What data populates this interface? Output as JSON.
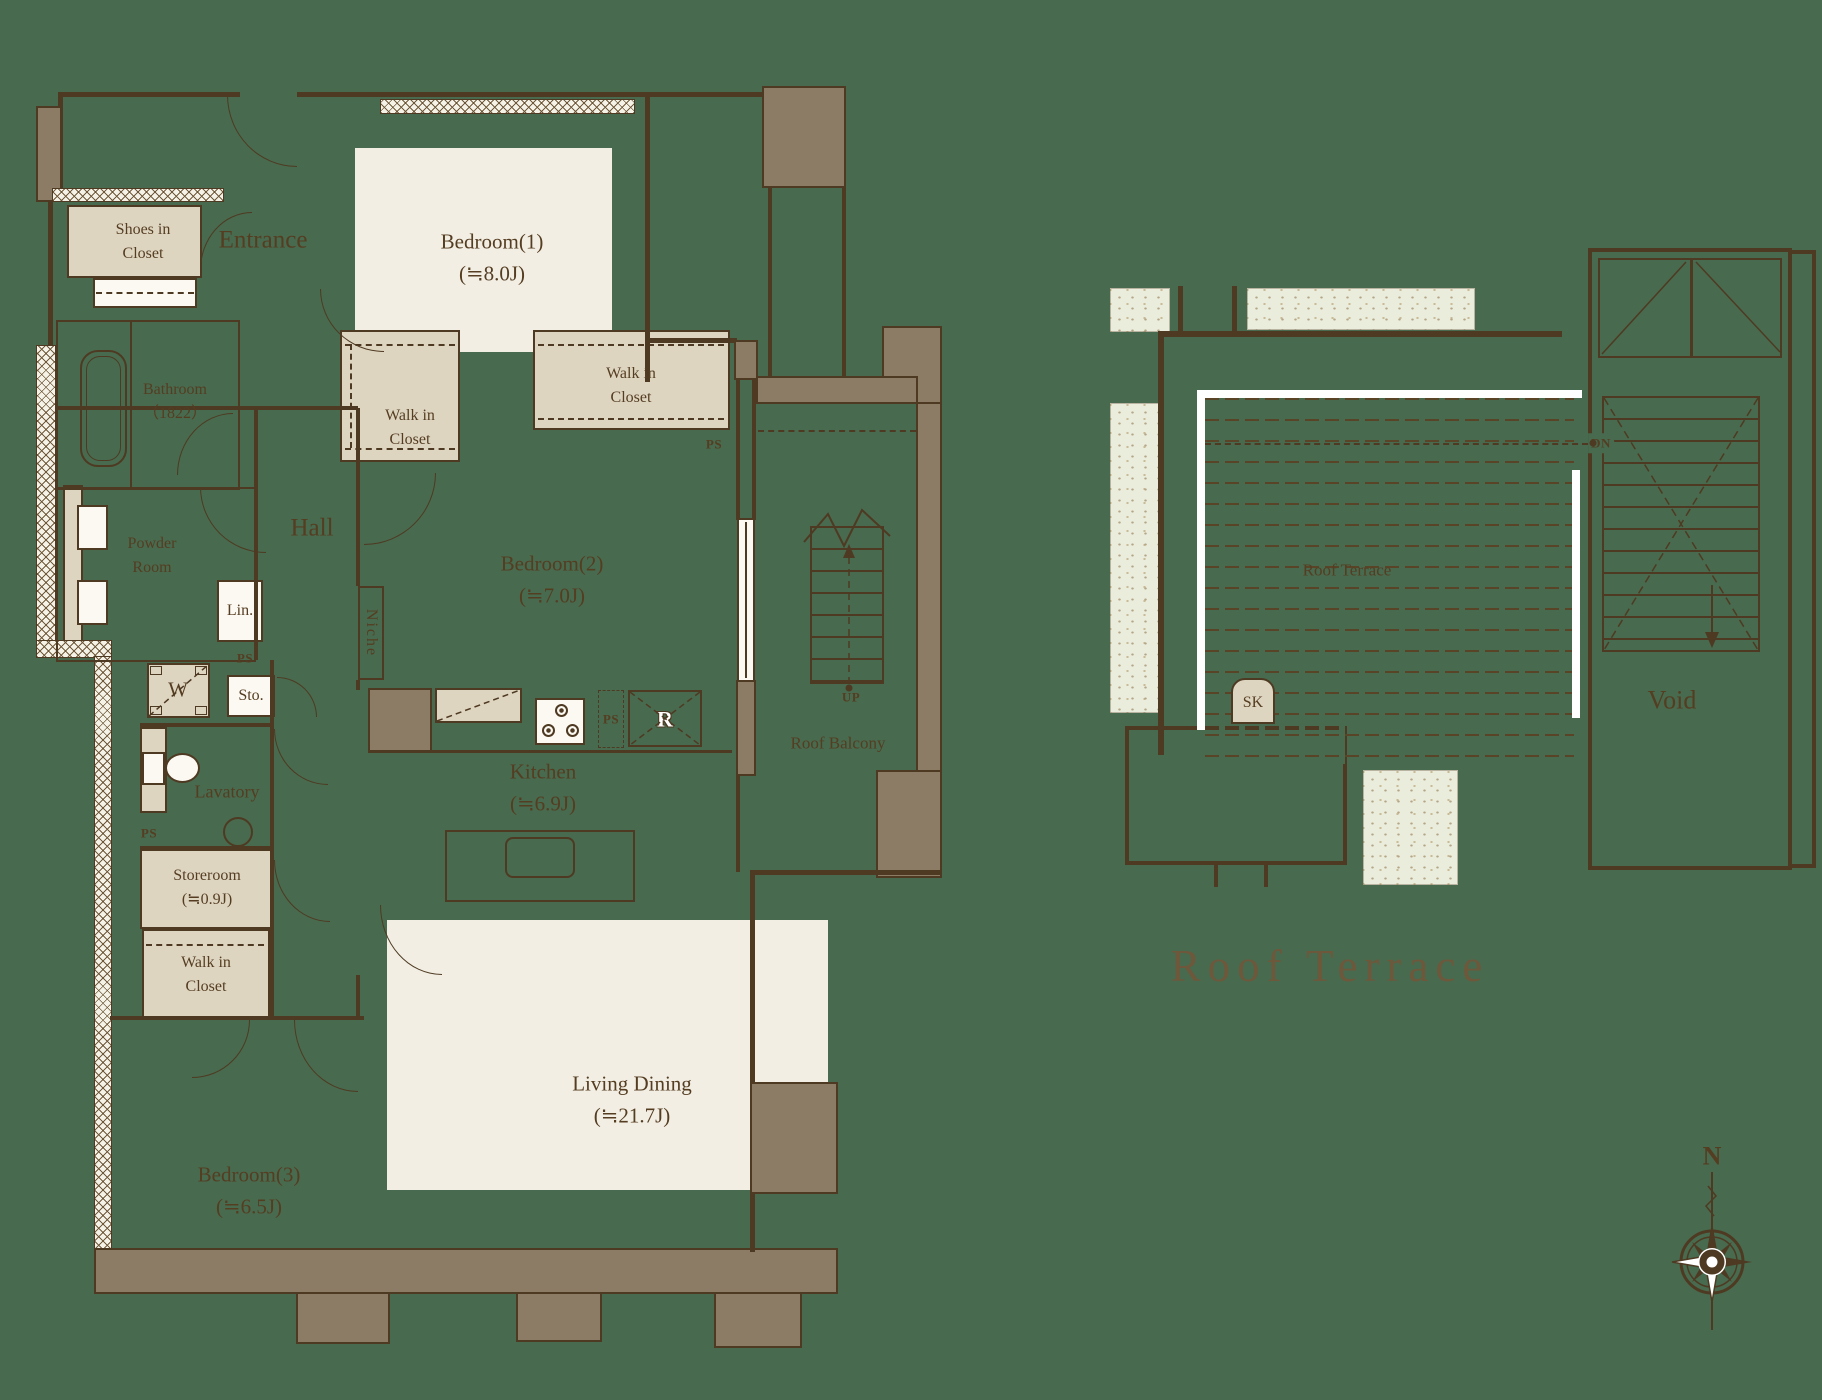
{
  "plan": {
    "unit": {
      "entrance": "Entrance",
      "shoes_closet": "Shoes in\nCloset",
      "bedroom1": "Bedroom(1)\n(≒8.0J)",
      "wic_left": "Walk in\nCloset",
      "wic_right": "Walk in\nCloset",
      "wic_bottom": "Walk in\nCloset",
      "ps_wic": "PS",
      "bathroom": "Bathroom\n（1822）",
      "powder_room": "Powder\nRoom",
      "hall": "Hall",
      "linen": "Lin.",
      "ps_hall": "PS",
      "storage": "Sto.",
      "washer": "W",
      "niche": "Niche",
      "bedroom2": "Bedroom(2)\n(≒7.0J)",
      "kitchen": "Kitchen\n(≒6.9J)",
      "ps_kitchen": "PS",
      "refrigerator": "R",
      "lavatory": "Lavatory",
      "ps_lavatory": "PS",
      "storeroom": "Storeroom\n(≒0.9J)",
      "bedroom3": "Bedroom(3)\n(≒6.5J)",
      "living_dining": "Living Dining\n(≒21.7J)",
      "roof_balcony": "Roof Balcony",
      "up": "UP"
    },
    "roof": {
      "roof_terrace_label": "Roof Terrace",
      "sink": "SK",
      "dn": "DN",
      "void": "Void"
    },
    "title": "Roof Terrace",
    "compass": {
      "north": "N"
    },
    "colors": {
      "background": "#486A4E",
      "line_brown": "#4E3A22",
      "wall_fill": "#8C7C66",
      "room_cream": "#F2EEE3",
      "closet_beige": "#DED5C1",
      "planter_green": "#EAECDC",
      "accent_white": "#FFFFFF",
      "title_brown": "#6E583C"
    }
  }
}
